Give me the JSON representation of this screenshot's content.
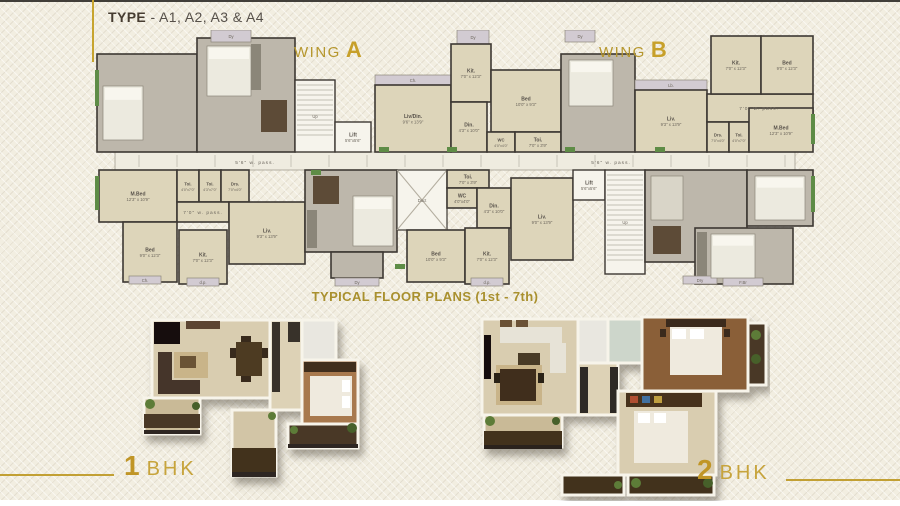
{
  "header": {
    "label_bold": "TYPE",
    "label_rest": "- A1, A2, A3 & A4"
  },
  "wing_a": {
    "prefix": "WING",
    "letter": "A"
  },
  "wing_b": {
    "prefix": "WING",
    "letter": "B"
  },
  "caption": "TYPICAL FLOOR PLANS (1st - 7th)",
  "legend": {
    "bhk1_num": "1",
    "bhk1_text": "BHK",
    "bhk2_num": "2",
    "bhk2_text": "BHK"
  },
  "colors": {
    "gold": "#c2a034",
    "title_dark": "#463c31",
    "wall": "#3d3833",
    "room_beige": "#ddd5ba",
    "room_gray": "#bdb7ab",
    "service": "#f6f4ec",
    "balcony": "#d2cbd2",
    "green": "#5e8c46",
    "corridor": "#efece0",
    "bed_icon": "#eceadf",
    "furniture_dark": "#5d4b37",
    "counter": "#8b8679",
    "sofa": "#d9d5c8"
  },
  "floor_plan": {
    "rooms": [
      {
        "n": "central-passage",
        "k": "c",
        "x": 20,
        "y": 122,
        "w": 680,
        "h": 18
      },
      {
        "n": "unit-furnished-left",
        "k": "f",
        "x": 2,
        "y": 24,
        "w": 100,
        "h": 98
      },
      {
        "n": "unit-furnished-left",
        "k": "f",
        "x": 102,
        "y": 8,
        "w": 98,
        "h": 114
      },
      {
        "n": "dy-balcony",
        "k": "b",
        "x": 116,
        "y": 0,
        "w": 40,
        "h": 12,
        "l": "Dy"
      },
      {
        "n": "stairs",
        "k": "st",
        "x": 200,
        "y": 50,
        "w": 40,
        "h": 72,
        "l": "Up"
      },
      {
        "n": "lift",
        "k": "s",
        "x": 240,
        "y": 92,
        "w": 36,
        "h": 30,
        "l": "Lift",
        "d": "5'6\"x5'6\""
      },
      {
        "n": "ch-balcony",
        "k": "b",
        "x": 280,
        "y": 45,
        "w": 76,
        "h": 10,
        "l": "Ch."
      },
      {
        "n": "living-dining",
        "k": "p",
        "x": 280,
        "y": 55,
        "w": 76,
        "h": 67,
        "l": "Liv/Din.",
        "d": "9'6\" x 13'9\""
      },
      {
        "n": "dy-balcony",
        "k": "b",
        "x": 362,
        "y": 0,
        "w": 32,
        "h": 14,
        "l": "Dy"
      },
      {
        "n": "kitchen",
        "k": "p",
        "x": 356,
        "y": 14,
        "w": 40,
        "h": 58,
        "l": "Kit.",
        "d": "7'0\" x 12'3\""
      },
      {
        "n": "bedroom",
        "k": "p",
        "x": 396,
        "y": 40,
        "w": 70,
        "h": 62,
        "l": "Bed",
        "d": "10'0\" x 9'3\""
      },
      {
        "n": "dining",
        "k": "p",
        "x": 356,
        "y": 72,
        "w": 36,
        "h": 50,
        "l": "Din.",
        "d": "4'3\" x 10'0\""
      },
      {
        "n": "wc",
        "k": "p",
        "x": 392,
        "y": 102,
        "w": 28,
        "h": 20,
        "l": "WC",
        "d": "4'0\"x4'0\""
      },
      {
        "n": "toilet",
        "k": "p",
        "x": 420,
        "y": 102,
        "w": 46,
        "h": 20,
        "l": "Toi.",
        "d": "7'0\" x 3'9\""
      },
      {
        "n": "unit-furnished-b",
        "k": "f",
        "x": 466,
        "y": 24,
        "w": 74,
        "h": 98
      },
      {
        "n": "dy-balcony",
        "k": "b",
        "x": 470,
        "y": 0,
        "w": 30,
        "h": 12,
        "l": "Dy"
      },
      {
        "n": "lb-balcony",
        "k": "b",
        "x": 540,
        "y": 50,
        "w": 72,
        "h": 10,
        "l": "Lb."
      },
      {
        "n": "living",
        "k": "p",
        "x": 540,
        "y": 60,
        "w": 72,
        "h": 62,
        "l": "Liv.",
        "d": "9'3\" x 13'9\""
      },
      {
        "n": "passage-area",
        "k": "p",
        "x": 612,
        "y": 64,
        "w": 106,
        "h": 28
      },
      {
        "n": "dressing",
        "k": "p",
        "x": 612,
        "y": 92,
        "w": 22,
        "h": 30,
        "l": "Drs.",
        "d": "7'0\"x4'0\""
      },
      {
        "n": "toilet",
        "k": "p",
        "x": 634,
        "y": 92,
        "w": 20,
        "h": 30,
        "l": "Toi.",
        "d": "4'0\"x7'0\""
      },
      {
        "n": "kitchen",
        "k": "p",
        "x": 616,
        "y": 6,
        "w": 50,
        "h": 58,
        "l": "Kit.",
        "d": "7'0\" x 12'3\""
      },
      {
        "n": "bedroom",
        "k": "p",
        "x": 666,
        "y": 6,
        "w": 52,
        "h": 58,
        "l": "Bed",
        "d": "9'0\" x 12'3\""
      },
      {
        "n": "master-bedroom",
        "k": "p",
        "x": 654,
        "y": 78,
        "w": 64,
        "h": 44,
        "l": "M.Bed",
        "d": "12'3\" x 10'9\""
      },
      {
        "n": "master-bedroom",
        "k": "p",
        "x": 4,
        "y": 140,
        "w": 78,
        "h": 52,
        "l": "M.Bed",
        "d": "12'3\" x 10'9\""
      },
      {
        "n": "toilet",
        "k": "p",
        "x": 82,
        "y": 140,
        "w": 22,
        "h": 32,
        "l": "Toi.",
        "d": "4'0\"x7'0\""
      },
      {
        "n": "toilet",
        "k": "p",
        "x": 104,
        "y": 140,
        "w": 22,
        "h": 32,
        "l": "Toi.",
        "d": "4'3\"x7'0\""
      },
      {
        "n": "dressing",
        "k": "p",
        "x": 126,
        "y": 140,
        "w": 28,
        "h": 32,
        "l": "Drs.",
        "d": "7'0\"x4'0\""
      },
      {
        "n": "passage-area",
        "k": "p",
        "x": 82,
        "y": 172,
        "w": 52,
        "h": 20
      },
      {
        "n": "living",
        "k": "p",
        "x": 134,
        "y": 172,
        "w": 76,
        "h": 62,
        "l": "Liv.",
        "d": "9'3\" x 13'9\""
      },
      {
        "n": "bedroom",
        "k": "p",
        "x": 28,
        "y": 192,
        "w": 54,
        "h": 60,
        "l": "Bed",
        "d": "9'0\" x 12'3\""
      },
      {
        "n": "kitchen",
        "k": "p",
        "x": 84,
        "y": 200,
        "w": 48,
        "h": 54,
        "l": "Kit.",
        "d": "7'0\" x 12'3\""
      },
      {
        "n": "ch-balcony",
        "k": "b",
        "x": 34,
        "y": 246,
        "w": 32,
        "h": 8,
        "l": "Ch."
      },
      {
        "n": "dp-balcony",
        "k": "b",
        "x": 92,
        "y": 248,
        "w": 32,
        "h": 8,
        "l": "d.p."
      },
      {
        "n": "unit-furnished-a2",
        "k": "f",
        "x": 210,
        "y": 140,
        "w": 92,
        "h": 82
      },
      {
        "n": "unit-furnished-a2",
        "k": "f",
        "x": 236,
        "y": 222,
        "w": 52,
        "h": 26
      },
      {
        "n": "dy-balcony",
        "k": "b",
        "x": 240,
        "y": 248,
        "w": 44,
        "h": 8,
        "l": "Dy"
      },
      {
        "n": "duct",
        "k": "d",
        "x": 302,
        "y": 140,
        "w": 50,
        "h": 60,
        "l": "Duct"
      },
      {
        "n": "toilet",
        "k": "p",
        "x": 352,
        "y": 140,
        "w": 42,
        "h": 18,
        "l": "Toi.",
        "d": "7'0\" x 3'9\""
      },
      {
        "n": "wc",
        "k": "p",
        "x": 352,
        "y": 158,
        "w": 30,
        "h": 20,
        "l": "WC",
        "d": "4'0\"x4'0\""
      },
      {
        "n": "dining",
        "k": "p",
        "x": 382,
        "y": 158,
        "w": 34,
        "h": 40,
        "l": "Din.",
        "d": "4'3\" x 10'0\""
      },
      {
        "n": "bedroom",
        "k": "p",
        "x": 312,
        "y": 200,
        "w": 58,
        "h": 52,
        "l": "Bed",
        "d": "10'0\" x 9'3\""
      },
      {
        "n": "kitchen",
        "k": "p",
        "x": 370,
        "y": 198,
        "w": 44,
        "h": 56,
        "l": "Kit.",
        "d": "7'0\" x 12'3\""
      },
      {
        "n": "dp-balcony",
        "k": "b",
        "x": 376,
        "y": 248,
        "w": 32,
        "h": 8,
        "l": "d.p."
      },
      {
        "n": "living",
        "k": "p",
        "x": 416,
        "y": 148,
        "w": 62,
        "h": 82,
        "l": "Liv.",
        "d": "9'0\" x 13'9\""
      },
      {
        "n": "lift",
        "k": "s",
        "x": 478,
        "y": 140,
        "w": 32,
        "h": 30,
        "l": "Lift",
        "d": "5'6\"x5'6\""
      },
      {
        "n": "stairs",
        "k": "st",
        "x": 510,
        "y": 140,
        "w": 40,
        "h": 104,
        "l": "Up"
      },
      {
        "n": "unit-furnished-right",
        "k": "f",
        "x": 550,
        "y": 140,
        "w": 102,
        "h": 92
      },
      {
        "n": "unit-furnished-right",
        "k": "f",
        "x": 652,
        "y": 140,
        "w": 66,
        "h": 56
      },
      {
        "n": "unit-furnished-right",
        "k": "f",
        "x": 600,
        "y": 198,
        "w": 98,
        "h": 56
      },
      {
        "n": "dry-balcony",
        "k": "b",
        "x": 588,
        "y": 246,
        "w": 34,
        "h": 8,
        "l": "Dry"
      },
      {
        "n": "fbr-balcony",
        "k": "b",
        "x": 628,
        "y": 248,
        "w": 40,
        "h": 8,
        "l": "F.Br"
      },
      {
        "n": "bed-icon",
        "k": "bed",
        "x": 112,
        "y": 16,
        "w": 44,
        "h": 50
      },
      {
        "n": "bed-icon",
        "k": "bed",
        "x": 8,
        "y": 56,
        "w": 40,
        "h": 54
      },
      {
        "n": "table-icon",
        "k": "table",
        "x": 166,
        "y": 70,
        "w": 26,
        "h": 32
      },
      {
        "n": "counter-icon",
        "k": "counter",
        "x": 156,
        "y": 14,
        "w": 10,
        "h": 46
      },
      {
        "n": "bed-icon",
        "k": "bed",
        "x": 474,
        "y": 30,
        "w": 44,
        "h": 46
      },
      {
        "n": "table-icon",
        "k": "table",
        "x": 218,
        "y": 146,
        "w": 26,
        "h": 28
      },
      {
        "n": "bed-icon",
        "k": "bed",
        "x": 258,
        "y": 166,
        "w": 40,
        "h": 50
      },
      {
        "n": "counter-icon",
        "k": "counter",
        "x": 212,
        "y": 180,
        "w": 10,
        "h": 38
      },
      {
        "n": "sofa-icon",
        "k": "sofa",
        "x": 556,
        "y": 146,
        "w": 32,
        "h": 44
      },
      {
        "n": "table-icon",
        "k": "table",
        "x": 558,
        "y": 196,
        "w": 28,
        "h": 28
      },
      {
        "n": "bed-icon",
        "k": "bed",
        "x": 660,
        "y": 146,
        "w": 50,
        "h": 44
      },
      {
        "n": "bed-icon",
        "k": "bed",
        "x": 616,
        "y": 204,
        "w": 44,
        "h": 44
      },
      {
        "n": "counter-icon",
        "k": "counter",
        "x": 602,
        "y": 202,
        "w": 10,
        "h": 44
      },
      {
        "n": "planter",
        "k": "g",
        "x": 0,
        "y": 40,
        "w": 4,
        "h": 36
      },
      {
        "n": "planter",
        "k": "g",
        "x": 0,
        "y": 146,
        "w": 4,
        "h": 34
      },
      {
        "n": "planter",
        "k": "g",
        "x": 716,
        "y": 84,
        "w": 4,
        "h": 30
      },
      {
        "n": "planter",
        "k": "g",
        "x": 716,
        "y": 146,
        "w": 4,
        "h": 36
      },
      {
        "n": "planter",
        "k": "g",
        "x": 284,
        "y": 117,
        "w": 10,
        "h": 5
      },
      {
        "n": "planter",
        "k": "g",
        "x": 352,
        "y": 117,
        "w": 10,
        "h": 5
      },
      {
        "n": "planter",
        "k": "g",
        "x": 470,
        "y": 117,
        "w": 10,
        "h": 5
      },
      {
        "n": "planter",
        "k": "g",
        "x": 560,
        "y": 117,
        "w": 10,
        "h": 5
      },
      {
        "n": "planter",
        "k": "g",
        "x": 216,
        "y": 140,
        "w": 10,
        "h": 5
      },
      {
        "n": "planter",
        "k": "g",
        "x": 300,
        "y": 234,
        "w": 10,
        "h": 5
      }
    ],
    "texts": [
      {
        "t": "5'6\" w. pass.",
        "x": 160,
        "y": 134
      },
      {
        "t": "5'6\" w. pass.",
        "x": 516,
        "y": 134
      },
      {
        "t": "7'0\" w. pass.",
        "x": 664,
        "y": 80
      },
      {
        "t": "7'0\" w. pass.",
        "x": 108,
        "y": 184
      }
    ]
  }
}
